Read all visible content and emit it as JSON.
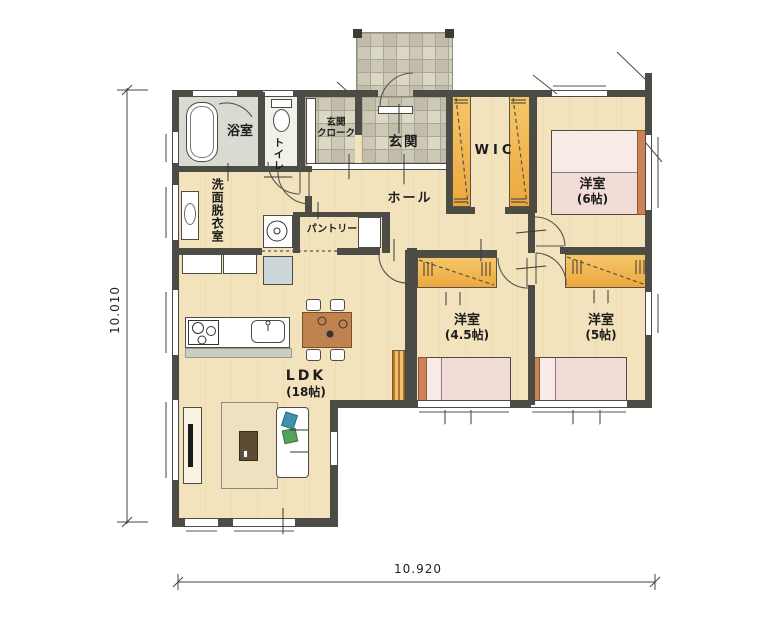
{
  "type": "japanese-floor-plan",
  "rooms": {
    "bath": "浴室",
    "toilet": "トイレ",
    "entrance_cloak": [
      "玄関",
      "クローク"
    ],
    "entrance": "玄関",
    "hall": "ホール",
    "wic": "WIC",
    "washroom": "洗面脱衣室",
    "pantry": "パントリー",
    "bedroom6": [
      "洋室",
      "(6帖)"
    ],
    "bedroom45": [
      "洋室",
      "(4.5帖)"
    ],
    "bedroom5": [
      "洋室",
      "(5帖)"
    ],
    "ldk": [
      "LDK",
      "(18帖)"
    ]
  },
  "dimensions": {
    "left": "10.010",
    "bottom": "10.920"
  },
  "colors": {
    "floor_wood": "#f3e3bc",
    "tile": "#dcd8c6",
    "wall": "#4c4b45",
    "closet_orange": "#f0b24a",
    "bed_pink": "#f8ebe7",
    "headboard": "#cd8157",
    "bath_floor": "#d9dbd2",
    "fridge": "#cbd6d8"
  }
}
